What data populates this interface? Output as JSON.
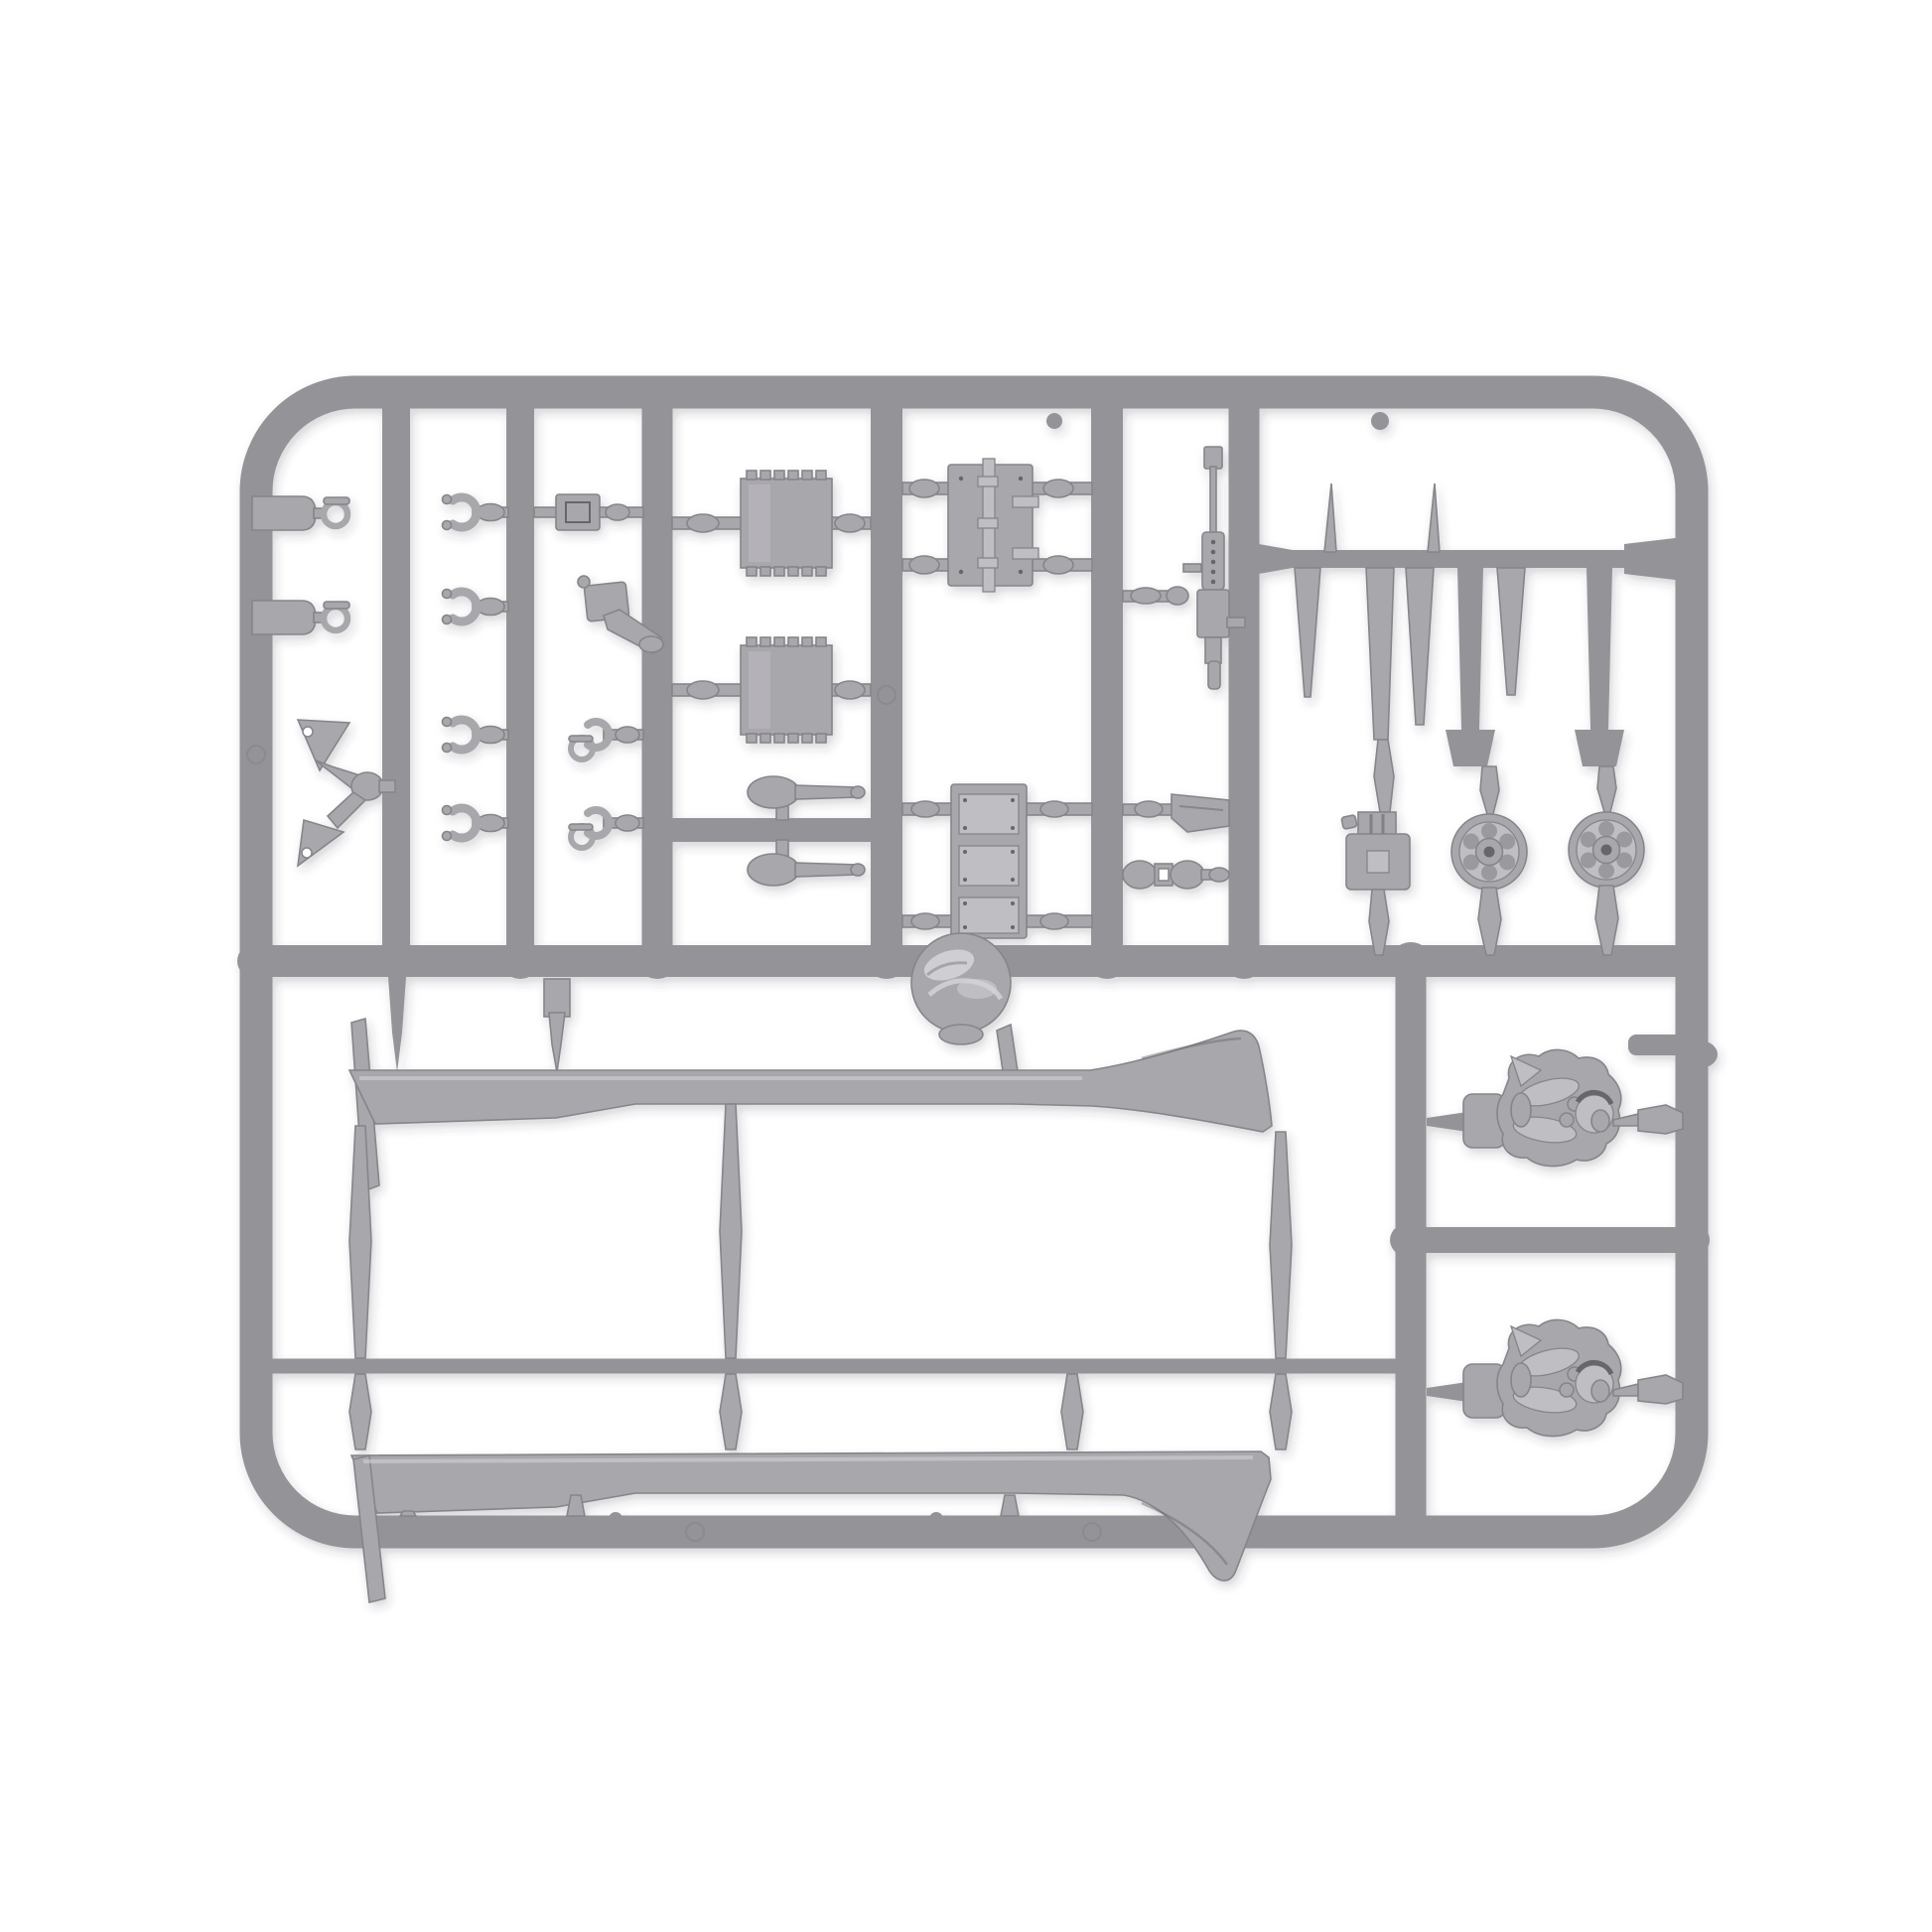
{
  "image": {
    "alt": "Photograph of a light grey polystyrene model kit sprue on a plain white background. The rounded rectangular runner frame holds small accessory parts in columns: two tow shackles, a triangular tow bracket, four clevis forks, two forks with D-rings, a coupling box, a funnel, two ribbed stowage plates, two mortar rounds on a crossbar, a hinged double-door hatch, a triple hatch panel, a pintle-mounted heavy machine gun, an entrenching blade, a twin coupling, a set of tail fins, a jerry can, two six-spoke road wheels, a domed cap, two long upturned sled runner skis, and two tank crew half figures.",
    "background_color": "#ffffff"
  },
  "colors": {
    "background": "#ffffff",
    "plastic": "#949398",
    "plastic_dark": "#7f7e83",
    "part": "#a8a7ac",
    "part_light": "#bfbec3",
    "part_dark": "#86858a",
    "detail_dark": "#67666b",
    "highlight": "#d6d6d9"
  },
  "sprue": {
    "material": "injection-moulded polystyrene",
    "color_name": "light grey",
    "frame_shape": "rounded rectangle",
    "parts": [
      {
        "name": "tow shackle",
        "count": 2,
        "area": "top left column"
      },
      {
        "name": "triangular tow bracket",
        "count": 1,
        "area": "left column, middle"
      },
      {
        "name": "clevis fork",
        "count": 4,
        "area": "second column, four rows"
      },
      {
        "name": "clevis fork with D-ring",
        "count": 2,
        "area": "third column, lower rows"
      },
      {
        "name": "coupling box",
        "count": 1,
        "area": "third column, row one"
      },
      {
        "name": "funnel",
        "count": 1,
        "area": "third column, row two"
      },
      {
        "name": "ribbed stowage plate",
        "count": 2,
        "area": "fourth column"
      },
      {
        "name": "mortar round",
        "count": 2,
        "area": "fourth column crossbar"
      },
      {
        "name": "hinged double-door hatch",
        "count": 1,
        "area": "fifth column, top"
      },
      {
        "name": "triple hatch panel",
        "count": 1,
        "area": "fifth column, bottom"
      },
      {
        "name": "heavy machine gun",
        "count": 1,
        "area": "sixth column"
      },
      {
        "name": "entrenching blade",
        "count": 1,
        "area": "sixth column, lower"
      },
      {
        "name": "twin coupling",
        "count": 1,
        "area": "sixth column, lower"
      },
      {
        "name": "tail fin set",
        "count": 1,
        "area": "top right cell"
      },
      {
        "name": "jerry can",
        "count": 1,
        "area": "right cell, wheel row"
      },
      {
        "name": "six-spoke road wheel",
        "count": 2,
        "area": "right cell, wheel row"
      },
      {
        "name": "domed cap",
        "count": 1,
        "area": "centre, on middle rail"
      },
      {
        "name": "sled runner ski",
        "count": 2,
        "area": "lower half, full width"
      },
      {
        "name": "crew half figure",
        "count": 2,
        "area": "lower right column"
      }
    ]
  }
}
